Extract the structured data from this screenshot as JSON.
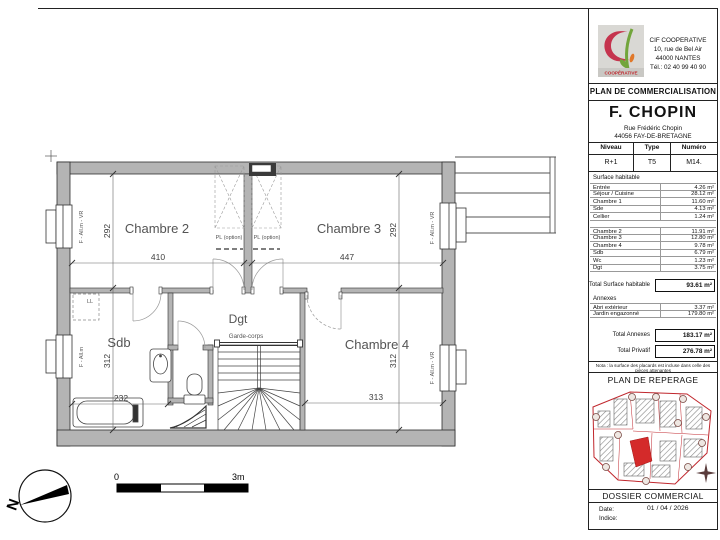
{
  "colors": {
    "wall_gray": "#b4b4b4",
    "site_red": "#c0272d",
    "logo_red": "#c5344e",
    "logo_green": "#72a53b",
    "logo_orange": "#e0782a"
  },
  "plan": {
    "rooms": {
      "chambre2": "Chambre 2",
      "chambre3": "Chambre 3",
      "chambre4": "Chambre 4",
      "sdb": "Sdb",
      "dgt": "Dgt"
    },
    "dims": {
      "c2_w": "410",
      "c2_h": "292",
      "c3_w": "447",
      "c3_h": "292",
      "c4_w": "313",
      "c4_h": "312",
      "sdb_w": "232",
      "sdb_h": "312"
    },
    "ann": {
      "pl_option": "PL (option)",
      "garde_corps": "Garde-corps",
      "ll": "LL",
      "win_vr": "F - All.m - VR",
      "win": "F - All.m"
    },
    "scale": {
      "zero": "0",
      "end": "3m"
    },
    "north": "N"
  },
  "titleblock": {
    "company": {
      "name": "CIF COOPERATIVE",
      "address1": "10, rue de Bel Air",
      "address2": "44000 NANTES",
      "phone": "Tél.: 02 40 99 40 90",
      "logo_sub": "COOPÉRATIVE"
    },
    "doc_title": "PLAN DE COMMERCIALISATION",
    "project": {
      "name": "F. CHOPIN",
      "street": "Rue Frédéric Chopin",
      "city": "44056 FAY-DE-BRETAGNE"
    },
    "unit": {
      "h_niveau": "Niveau",
      "h_type": "Type",
      "h_numero": "Numéro",
      "niveau": "R+1",
      "type": "T5",
      "numero": "M14."
    },
    "surface_section": "Surface habitable",
    "rows1": [
      {
        "label": "Entrée",
        "value": "4.26 m²"
      },
      {
        "label": "Séjour / Cuisine",
        "value": "28.12 m²"
      },
      {
        "label": "Chambre 1",
        "value": "11.60 m²"
      },
      {
        "label": "Sde",
        "value": "4.13 m²"
      },
      {
        "label": "Cellier",
        "value": "1.24 m²"
      }
    ],
    "rows2": [
      {
        "label": "Chambre 2",
        "value": "11.91 m²"
      },
      {
        "label": "Chambre 3",
        "value": "12.80 m²"
      },
      {
        "label": "Chambre 4",
        "value": "9.78 m²"
      },
      {
        "label": "Sdb",
        "value": "6.79 m²"
      },
      {
        "label": "Wc",
        "value": "1.23 m²"
      },
      {
        "label": "Dgt",
        "value": "3.75 m²"
      }
    ],
    "total_hab_label": "Total Surface habitable",
    "total_hab_value": "93.61 m²",
    "annexes_label": "Annexes",
    "annex_rows": [
      {
        "label": "Abri extérieur",
        "value": "3.37 m²"
      },
      {
        "label": "Jardin engazonné",
        "value": "179.80 m²"
      }
    ],
    "total_annexes_label": "Total Annexes",
    "total_annexes_value": "183.17 m²",
    "total_privatif_label": "Total Privatif",
    "total_privatif_value": "276.78 m²",
    "note": "Nota : la surface des placards est incluse dans celle des pièces attenantes",
    "reperage_title": "PLAN DE REPERAGE",
    "footer": {
      "title": "DOSSIER COMMERCIAL",
      "date_label": "Date:",
      "date_value": "01 / 04 / 2026",
      "indice_label": "Indice:"
    }
  }
}
